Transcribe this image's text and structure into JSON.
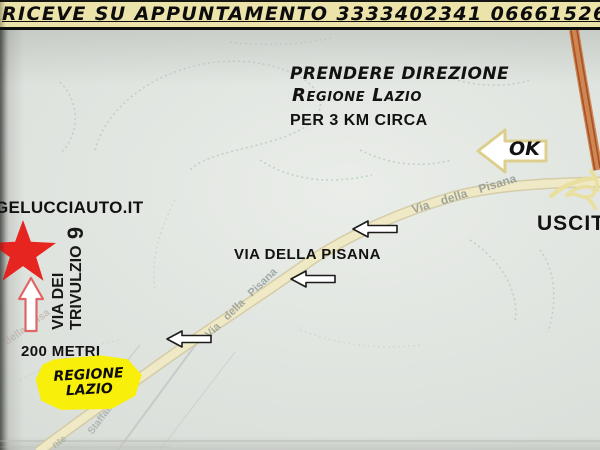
{
  "banner": {
    "text": "RICEVE SU APPUNTAMENTO 3333402341  0666152690"
  },
  "directions": {
    "line1": "PRENDERE DIREZIONE",
    "line2": "Regione Lazio",
    "line3": "PER 3 KM CIRCA"
  },
  "destination": {
    "website": "GELUCCIAUTO.IT",
    "street_line1": "VIA DEI",
    "street_line2": "TRIVULZIO",
    "street_number": "9",
    "distance": "200 METRI"
  },
  "map": {
    "main_road_label": "VIA DELLA PISANA",
    "exit_label": "USCITA",
    "ok_label": "OK",
    "sign": {
      "line1": "REGIONE",
      "line2": "LAZIO"
    },
    "road_names": {
      "pisana_upper": "Via della Pisana",
      "pisana_lower": "Via della Pisana",
      "pisana_faint": "della Pisa",
      "side_street": "Staffabara",
      "side_street2": "nte"
    }
  },
  "colors": {
    "banner_bg": "#ece3ab",
    "map_bg": "#d9ded9",
    "road_fill": "#f0e9c6",
    "highway_orange": "#cf8148",
    "sign_yellow": "#f8ef0a",
    "star_red": "#e62420",
    "arrow_white": "#ffffff",
    "contour_teal": "#b7c9c1"
  }
}
